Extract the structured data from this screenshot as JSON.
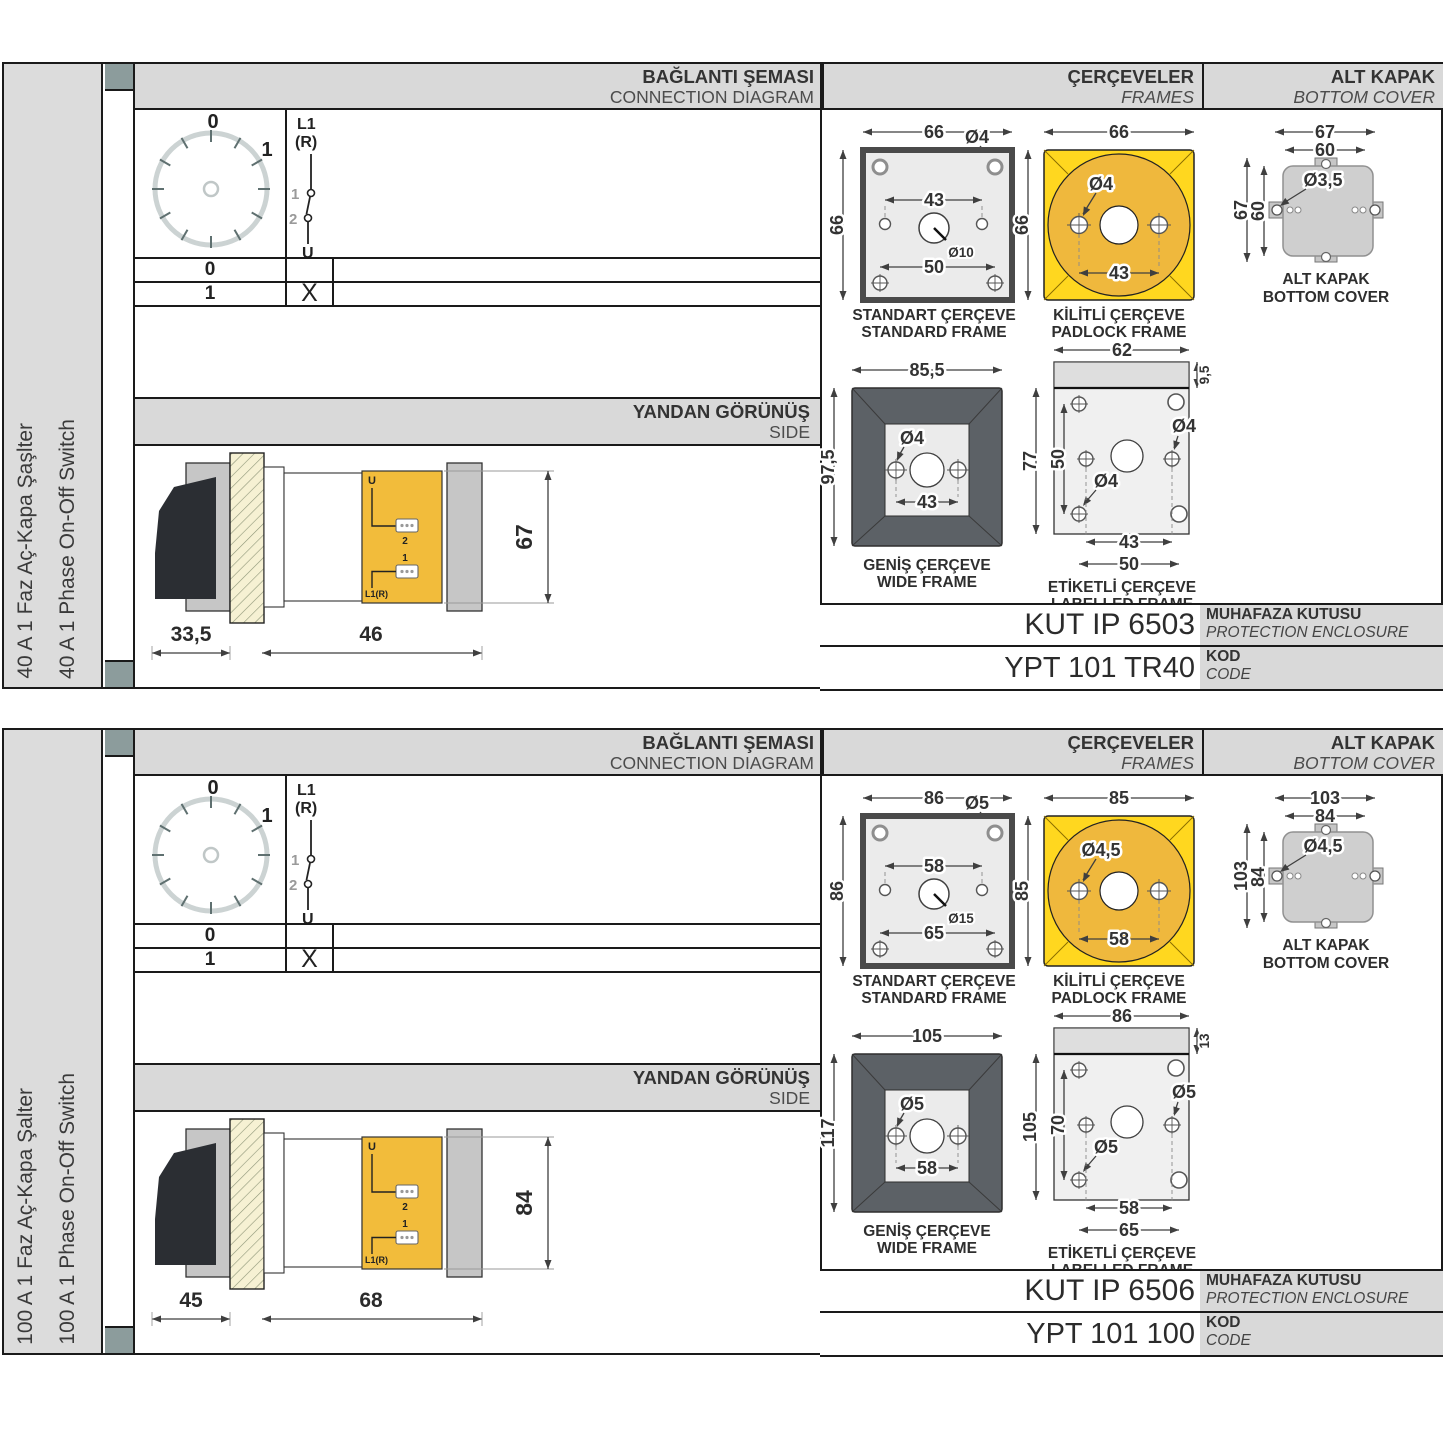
{
  "headers": {
    "connection_tr": "BAĞLANTI ŞEMASI",
    "connection_en": "CONNECTION DIAGRAM",
    "frames_tr": "ÇERÇEVELER",
    "frames_en": "FRAMES",
    "cover_tr": "ALT KAPAK",
    "cover_en": "BOTTOM COVER",
    "side_tr": "YANDAN GÖRÜNÜŞ",
    "side_en": "SIDE",
    "enclosure_tr": "MUHAFAZA KUTUSU",
    "enclosure_en": "PROTECTION ENCLOSURE",
    "code_tr": "KOD",
    "code_en": "CODE"
  },
  "captions": {
    "standard_tr": "STANDART ÇERÇEVE",
    "standard_en": "STANDARD FRAME",
    "padlock_tr": "KİLİTLİ ÇERÇEVE",
    "padlock_en": "PADLOCK FRAME",
    "wide_tr": "GENİŞ ÇERÇEVE",
    "wide_en": "WIDE FRAME",
    "labelled_tr": "ETİKETLİ ÇERÇEVE",
    "labelled_en": "LABELLED FRAME",
    "cover_tr": "ALT KAPAK",
    "cover_en": "BOTTOM COVER"
  },
  "diagram": {
    "pos_zero": "0",
    "pos_one": "1",
    "line_label": "L1",
    "line_label2": "(R)",
    "contact_1": "1",
    "contact_2": "2",
    "load_label": "U",
    "row_zero": "0",
    "row_one": "1",
    "closed_mark": "X"
  },
  "side_terminals": {
    "u": "U",
    "t2": "2",
    "t1": "1",
    "l1r": "L1(R)"
  },
  "colors": {
    "band_gray": "#D9D9D9",
    "marker_gray": "#8C9C9C",
    "side_yellow": "#F2BC3B",
    "padlock_square": "#FFD71F",
    "padlock_circle": "#EFB83D"
  },
  "sections": [
    {
      "title_tr": "40 A 1 Faz Aç-Kapa Şaşlter",
      "title_en": "40 A 1 Phase On-Off Switch",
      "standard": {
        "width": "66",
        "height": "66",
        "hole": "Ø4",
        "span": "43",
        "center": "Ø10",
        "bottom_span": "50"
      },
      "padlock": {
        "width": "66",
        "height": "66",
        "hole": "Ø4",
        "span": "43"
      },
      "wide": {
        "width": "85,5",
        "height": "97,5",
        "hole": "Ø4",
        "span": "43"
      },
      "labelled": {
        "width": "62",
        "strip": "9,5",
        "height": "77",
        "inner": "50",
        "hole_right": "Ø4",
        "hole_left": "Ø4",
        "span": "43",
        "span2": "50"
      },
      "cover": {
        "outer_w": "67",
        "inner_w": "60",
        "outer_h": "67",
        "inner_h": "60",
        "hole": "Ø3,5"
      },
      "side": {
        "depth_rear": "33,5",
        "depth_front": "46",
        "height": "67"
      },
      "enclosure": "KUT IP 6503",
      "code": "YPT 101 TR40"
    },
    {
      "title_tr": "100 A 1 Faz Aç-Kapa Şalter",
      "title_en": "100 A 1 Phase On-Off Switch",
      "standard": {
        "width": "86",
        "height": "86",
        "hole": "Ø5",
        "span": "58",
        "center": "Ø15",
        "bottom_span": "65"
      },
      "padlock": {
        "width": "85",
        "height": "85",
        "hole": "Ø4,5",
        "span": "58"
      },
      "wide": {
        "width": "105",
        "height": "117",
        "hole": "Ø5",
        "span": "58"
      },
      "labelled": {
        "width": "86",
        "strip": "13",
        "height": "105",
        "inner": "70",
        "hole_right": "Ø5",
        "hole_left": "Ø5",
        "span": "58",
        "span2": "65"
      },
      "cover": {
        "outer_w": "103",
        "inner_w": "84",
        "outer_h": "103",
        "inner_h": "84",
        "hole": "Ø4,5"
      },
      "side": {
        "depth_rear": "45",
        "depth_front": "68",
        "height": "84"
      },
      "enclosure": "KUT IP 6506",
      "code": "YPT 101 100"
    }
  ]
}
